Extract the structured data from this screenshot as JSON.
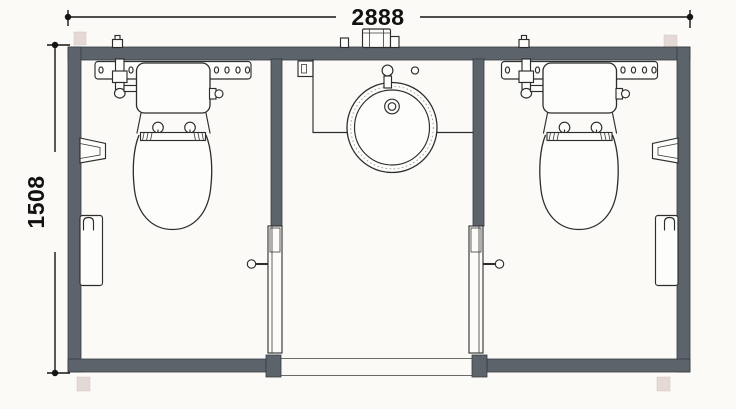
{
  "drawing": {
    "type": "architectural-floor-plan",
    "description": "top-view plan of a twin-cubicle toilet module with central washbasin vestibule",
    "dimension_labels": {
      "width": "2888",
      "height": "1508"
    },
    "colors": {
      "wall": "#5c636b",
      "linework": "#2d2d2d",
      "paper": "#fbfaf7",
      "foot_pad": "#ddcfca",
      "dimension_text": "#111111"
    },
    "elements": {
      "left_cubicle": [
        "carrier-rail",
        "inlet-valve",
        "cistern",
        "toilet-bowl",
        "seat-hinges",
        "wall-holder",
        "waste-bin",
        "door",
        "door-handle"
      ],
      "vestibule": [
        "counter",
        "washbasin",
        "tap",
        "drain",
        "wall-box",
        "entry-threshold"
      ],
      "right_cubicle": [
        "carrier-rail",
        "inlet-valve",
        "cistern",
        "toilet-bowl",
        "seat-hinges",
        "wall-holder",
        "waste-bin",
        "door",
        "door-handle"
      ],
      "exterior": [
        "roof-unit",
        "foot-pads",
        "dimension-lines"
      ]
    }
  }
}
